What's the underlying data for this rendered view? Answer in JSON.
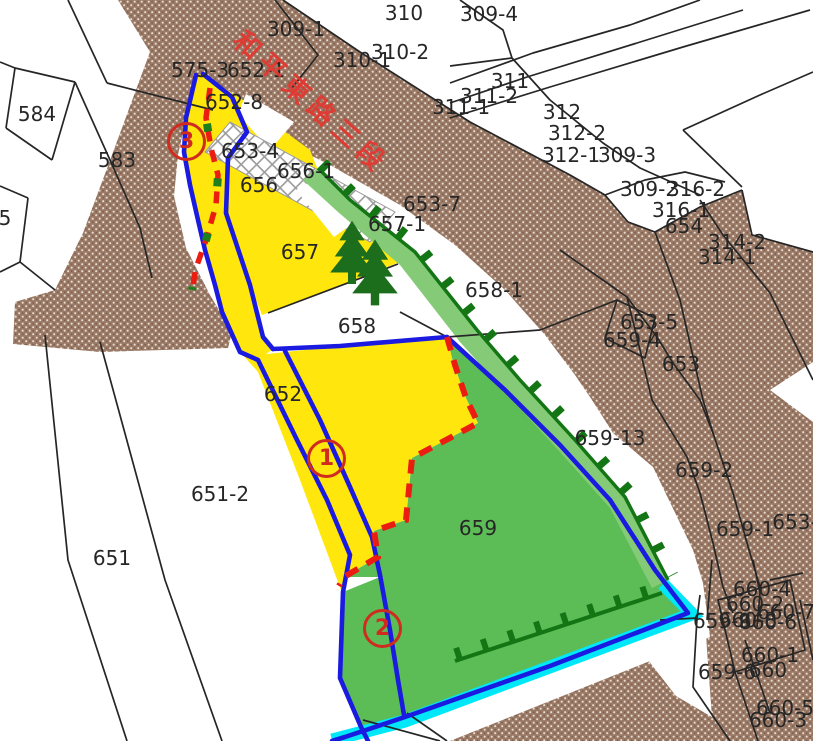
{
  "map": {
    "type": "cadastral-parcel-map",
    "road_name": "和平東路三段",
    "colors": {
      "road_hatch_brown": "#9a7a66",
      "parcel_yellow": "#ffe70d",
      "parcel_green": "#5cbd57",
      "levee_band_green": "#85cb77",
      "boundary_blue": "#1a1ae0",
      "dashed_red": "#ea1d10",
      "tick_green": "#147514",
      "water_cyan": "#00e8f8",
      "label_text": "#262626",
      "road_label_red": "#e23c33"
    },
    "parcel_labels": [
      {
        "text": "310",
        "x": 404,
        "y": 13
      },
      {
        "text": "309-4",
        "x": 489,
        "y": 14
      },
      {
        "text": "309-1",
        "x": 296,
        "y": 29
      },
      {
        "text": "310-2",
        "x": 400,
        "y": 52
      },
      {
        "text": "310-1",
        "x": 362,
        "y": 60
      },
      {
        "text": "575-3",
        "x": 200,
        "y": 70
      },
      {
        "text": "652-1",
        "x": 256,
        "y": 70
      },
      {
        "text": "311",
        "x": 510,
        "y": 81
      },
      {
        "text": "311-2",
        "x": 489,
        "y": 96
      },
      {
        "text": "652-8",
        "x": 234,
        "y": 102
      },
      {
        "text": "311-1",
        "x": 461,
        "y": 107
      },
      {
        "text": "312",
        "x": 562,
        "y": 112
      },
      {
        "text": "584",
        "x": 37,
        "y": 114
      },
      {
        "text": "312-2",
        "x": 577,
        "y": 133
      },
      {
        "text": "653-4",
        "x": 250,
        "y": 151
      },
      {
        "text": "312-1",
        "x": 571,
        "y": 155
      },
      {
        "text": "309-3",
        "x": 627,
        "y": 155
      },
      {
        "text": "583",
        "x": 117,
        "y": 160
      },
      {
        "text": "656-1",
        "x": 306,
        "y": 171
      },
      {
        "text": "656",
        "x": 259,
        "y": 185
      },
      {
        "text": "309-2",
        "x": 649,
        "y": 189
      },
      {
        "text": "316-2",
        "x": 696,
        "y": 189
      },
      {
        "text": "653-7",
        "x": 432,
        "y": 204
      },
      {
        "text": "316-1",
        "x": 681,
        "y": 210
      },
      {
        "text": "5",
        "x": 5,
        "y": 218
      },
      {
        "text": "657-1",
        "x": 397,
        "y": 224
      },
      {
        "text": "654",
        "x": 684,
        "y": 226
      },
      {
        "text": "314-2",
        "x": 737,
        "y": 242
      },
      {
        "text": "657",
        "x": 300,
        "y": 252
      },
      {
        "text": "314-1",
        "x": 727,
        "y": 257
      },
      {
        "text": "658-1",
        "x": 494,
        "y": 290
      },
      {
        "text": "653-5",
        "x": 649,
        "y": 322
      },
      {
        "text": "658",
        "x": 357,
        "y": 326
      },
      {
        "text": "659-4",
        "x": 632,
        "y": 340
      },
      {
        "text": "653",
        "x": 681,
        "y": 364
      },
      {
        "text": "652",
        "x": 283,
        "y": 394
      },
      {
        "text": "659-13",
        "x": 610,
        "y": 438
      },
      {
        "text": "659-2",
        "x": 704,
        "y": 470
      },
      {
        "text": "651-2",
        "x": 220,
        "y": 494
      },
      {
        "text": "653-",
        "x": 795,
        "y": 522
      },
      {
        "text": "659",
        "x": 478,
        "y": 528
      },
      {
        "text": "659-1",
        "x": 745,
        "y": 529
      },
      {
        "text": "651",
        "x": 112,
        "y": 558
      },
      {
        "text": "660-4",
        "x": 762,
        "y": 589
      },
      {
        "text": "660-2",
        "x": 755,
        "y": 604
      },
      {
        "text": "660-7",
        "x": 786,
        "y": 612
      },
      {
        "text": "660-8",
        "x": 748,
        "y": 620
      },
      {
        "text": "659-9",
        "x": 722,
        "y": 621
      },
      {
        "text": "660-6",
        "x": 768,
        "y": 622
      },
      {
        "text": "660-1",
        "x": 770,
        "y": 655
      },
      {
        "text": "660",
        "x": 768,
        "y": 670
      },
      {
        "text": "659-6",
        "x": 727,
        "y": 672
      },
      {
        "text": "660-5",
        "x": 785,
        "y": 708
      },
      {
        "text": "660-3",
        "x": 778,
        "y": 720
      }
    ],
    "circle_markers": [
      {
        "num": "3",
        "x": 186,
        "y": 141
      },
      {
        "num": "1",
        "x": 326,
        "y": 458
      },
      {
        "num": "2",
        "x": 382,
        "y": 628
      }
    ]
  }
}
